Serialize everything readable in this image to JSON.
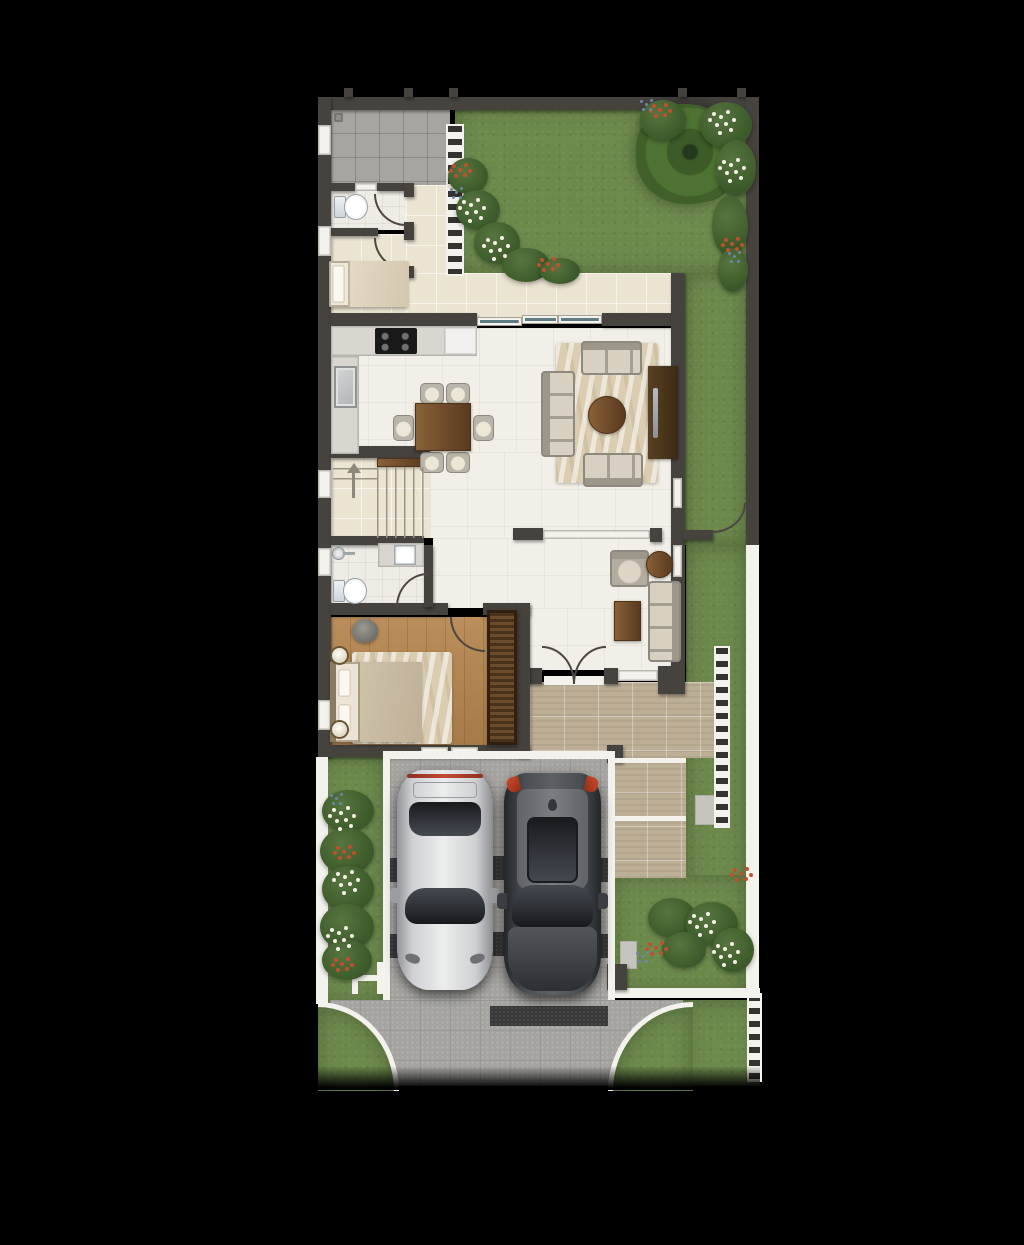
{
  "scene": {
    "description": "Top-down rendered ground-floor plan of a townhouse: service yard, WC, maid room, kitchen with dining for six, living area with TV console, staircase, bathroom, timber-floor bedroom with wardrobe, foyer with french doors, timber terrace deck, rear and side lawns with tree and flower beds, and a flared front driveway with a silver coupe and a charcoal SUV parked side by side",
    "colors": {
      "wall": "#46423e",
      "white": "#f4f2ed",
      "glass": "#5e7c82",
      "grass": "#6d8a4d",
      "marble": "#f2efe8",
      "cream": "#ece4d2",
      "gtile": "#a8a5a0",
      "wood": "#b5854e",
      "wardrobe": "#5d4226",
      "deck": "#bdae96",
      "drive": "#a5a4a1",
      "drivedark": "#3a3a3a",
      "rug": "#dacdb2",
      "sofa": "#b3ac9e",
      "cushion": "#d8d1c2",
      "tablewood": "#7a5531",
      "red": "#c0502f",
      "blue": "#6c86ae",
      "flower": "#f4f0e3",
      "carsilver": "#d5d6d7",
      "cardark": "#44484d"
    },
    "floor_plan": {
      "rooms": [
        {
          "name": "service-yard",
          "floor": "grey-tile",
          "features": [
            "floor-drain",
            "slat-screen"
          ]
        },
        {
          "name": "wc",
          "fixtures": [
            "toilet"
          ]
        },
        {
          "name": "maid-room",
          "furniture": [
            "single-bed"
          ]
        },
        {
          "name": "corridor",
          "floor": "cream-tile"
        },
        {
          "name": "kitchen",
          "fixtures": [
            "l-shaped-counter",
            "4-burner-hob",
            "sink",
            "counter-appliance"
          ]
        },
        {
          "name": "dining-area",
          "furniture": [
            "dining-table",
            "six-chairs"
          ]
        },
        {
          "name": "living-area",
          "furniture": [
            "three-seat-sofa",
            "loveseat-north",
            "loveseat-south",
            "round-coffee-table",
            "tv-console",
            "patterned-rug"
          ]
        },
        {
          "name": "staircase",
          "detail": "up"
        },
        {
          "name": "bathroom",
          "fixtures": [
            "shower",
            "vanity-sink",
            "toilet"
          ]
        },
        {
          "name": "bedroom",
          "floor": "timber",
          "furniture": [
            "double-bed",
            "bedside-lamps",
            "stool",
            "rug",
            "slatted-wardrobe"
          ]
        },
        {
          "name": "foyer",
          "furniture": [
            "armchair",
            "round-side-table",
            "settee",
            "coffee-table"
          ],
          "features": [
            "double-french-doors"
          ]
        },
        {
          "name": "terrace-deck",
          "features": [
            "timber-deck",
            "trellis-screen",
            "steps"
          ]
        }
      ],
      "outdoor": [
        {
          "name": "rear-garden",
          "features": [
            "lawn",
            "tree",
            "flower-beds",
            "slat-fence"
          ]
        },
        {
          "name": "side-garden",
          "features": [
            "lawn",
            "side-gate"
          ]
        },
        {
          "name": "front-garden",
          "features": [
            "lawn",
            "flower-beds",
            "gate-mark",
            "white-boundary-fence"
          ]
        },
        {
          "name": "driveway",
          "features": [
            "paved-apron",
            "flared-street-entry",
            "dark-accent-bands",
            "kerbs"
          ],
          "vehicles": [
            "silver-coupe",
            "charcoal-suv"
          ]
        }
      ]
    }
  }
}
